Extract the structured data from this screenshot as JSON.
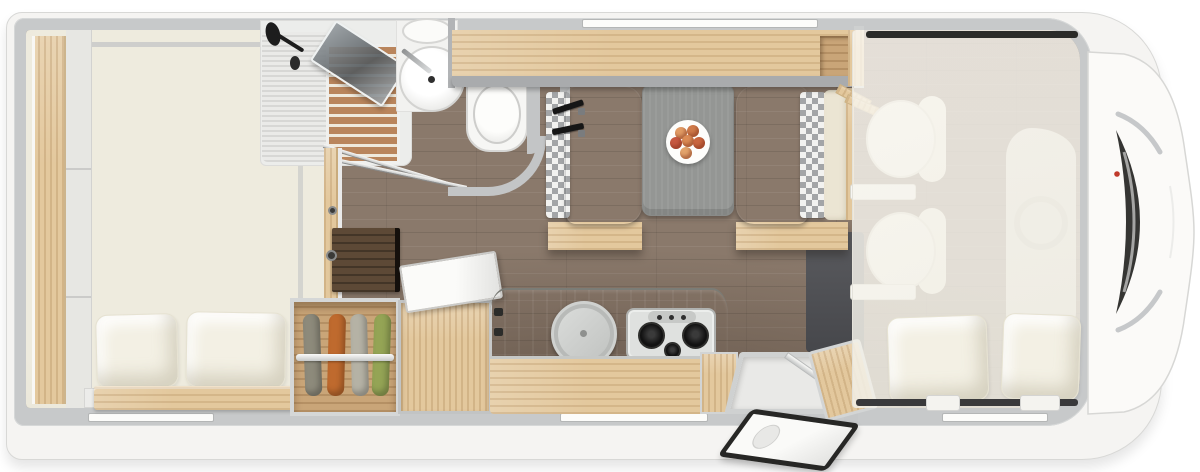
{
  "title": "Motorhome floor plan, top view",
  "colors": {
    "body": "#f5f4f2",
    "wall": "#c7c9ca",
    "floor": "#8a796b",
    "mattress": "#eeebde",
    "pillow": "#f3f0e4",
    "wood": "#e3c89d",
    "wood_dark": "#c9a578",
    "walnut": "#5d4936",
    "teak": "#b9855c",
    "bench": "#717274",
    "checker_dark": "#a3a5a7",
    "checker_light": "#f2f2f0",
    "table": "#949694",
    "counter": "#63645e",
    "steel": "#b8bab8",
    "windshield": "#353533",
    "red": "#c03a2b",
    "door_seal": "#272725"
  },
  "areas": {
    "bedroom": {
      "label": "Rear bedroom with double bed, two pillows and side shelf",
      "pillows": 2
    },
    "shower": {
      "label": "Shower cabin with teak grate and folding glass door"
    },
    "washroom": {
      "label": "Washbasin and bench toilet"
    },
    "overhead": {
      "label": "Overhead locker shelf above dinette"
    },
    "dinette": {
      "label": "Face-to-face dinette with two benches and seat belts",
      "benches": 2,
      "seatbelts": 2
    },
    "table": {
      "label": "Dinette table with plate of fruit",
      "fruits": 6
    },
    "kitchen": {
      "label": "Kitchen block with covered round sink and 3-burner gas hob",
      "burners": 3
    },
    "chest": {
      "label": "Storage chest with open lid"
    },
    "wardrobe": {
      "label": "Open wardrobe with four hanging garments",
      "garments": 4
    },
    "tv": {
      "label": "Dark wood cabinet top"
    },
    "entry": {
      "label": "Entry step and open entry door"
    },
    "cab": {
      "label": "Driver cab, two swivel seats under lowered drop-down bed",
      "seats": 2,
      "pillows": 2
    },
    "front": {
      "label": "Vehicle front end with windshield"
    }
  },
  "garment_colors": [
    "#8d8a7b",
    "#bf6a2e",
    "#b5b2a5",
    "#94a455"
  ],
  "fruit_colors": [
    "#e09a63",
    "#cf7a49",
    "#c65840",
    "#db8b55",
    "#c9663f",
    "#e2a36b"
  ]
}
